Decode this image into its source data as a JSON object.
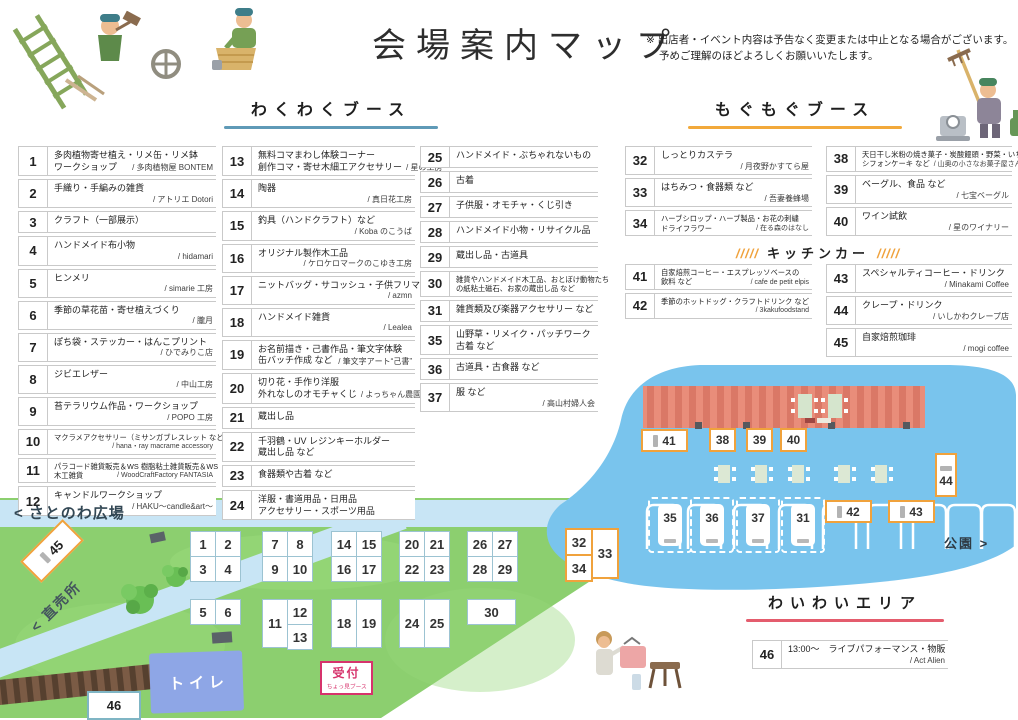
{
  "header": {
    "title": "会場案内マップ",
    "note1": "※ 出店者・イベント内容は予告なく変更または中止となる場合がございます。",
    "note2": "予めご理解のほどよろしくお願いいたします。"
  },
  "sections": {
    "wakuwaku": "わくわくブース",
    "mogumogu": "もぐもぐブース",
    "kitchen": "キッチンカー",
    "kitchen_slash": "/////",
    "waiwai": "わいわいエリア"
  },
  "colors": {
    "wakuwaku_underline": "#5f9ab7",
    "mogumogu_underline": "#f2a93b",
    "waiwai_underline": "#e45c6d",
    "kitchen_orange": "#f0a23c",
    "reception_pink": "#d6336c",
    "grass": "#8ccf6f",
    "water": "#79c4ed",
    "road": "#c8e5f5",
    "toilet_building": "#8ea6e6",
    "stage_building": "#e98d7a"
  },
  "booths": {
    "col1": [
      {
        "num": "1",
        "l1": "多肉植物寄せ植え・リメ缶・リメ鉢",
        "l2": "ワークショップ",
        "v": "/ 多肉植物屋 BONTEM"
      },
      {
        "num": "2",
        "l1": "手織り・手編みの雑貨",
        "v": "/ アトリエ Dotori"
      },
      {
        "num": "3",
        "l1": "クラフト（一部展示）"
      },
      {
        "num": "4",
        "l1": "ハンドメイド布小物",
        "v": "/ hidamari"
      },
      {
        "num": "5",
        "l1": "ヒンメリ",
        "v": "/ simarie 工房"
      },
      {
        "num": "6",
        "l1": "季節の草花苗・寄せ植えづくり",
        "v": "/ 朧月"
      },
      {
        "num": "7",
        "l1": "ぽち袋・ステッカー・はんこプリント",
        "v": "/ ひでみりこ店"
      },
      {
        "num": "8",
        "l1": "ジビエレザー",
        "v": "/ 中山工房"
      },
      {
        "num": "9",
        "l1": "苔テラリウム作品・ワークショップ",
        "v": "/ POPO 工房"
      },
      {
        "num": "10",
        "sm": true,
        "l1": "マクラメアクセサリー（ミサンガブレスレット など）",
        "v": "/ hana・ray macrame accessory"
      },
      {
        "num": "11",
        "sm": true,
        "l1": "パラコード雑貨販売＆WS 樹脂粘土雑貨販売＆WS",
        "l2": "木工雑貨",
        "v": "/ WoodCraftFactory FANTASIA"
      },
      {
        "num": "12",
        "l1": "キャンドルワークショップ",
        "v": "/ HAKU〜candle&art〜"
      }
    ],
    "col2": [
      {
        "num": "13",
        "l1": "無料コマまわし体験コーナー",
        "l2": "創作コマ・寄せ木細工アクセサリー",
        "v": "/ 星の工房"
      },
      {
        "num": "14",
        "l1": "陶器",
        "v": "/ 真日花工房"
      },
      {
        "num": "15",
        "l1": "釣具（ハンドクラフト）など",
        "v": "/ Koba のこうば"
      },
      {
        "num": "16",
        "l1": "オリジナル製作木工品",
        "v": "/ ケロケロマークのこゆき工房"
      },
      {
        "num": "17",
        "l1": "ニットバッグ・サコッシュ・子供フリマ",
        "v": "/ azmn"
      },
      {
        "num": "18",
        "l1": "ハンドメイド雑貨",
        "v": "/ Lealea"
      },
      {
        "num": "19",
        "l1": "お名前描き・己書作品・筆文字体験",
        "l2": "缶バッチ作成 など",
        "v": "/ 筆文字アート“己書”"
      },
      {
        "num": "20",
        "l1": "切り花・手作り洋服",
        "l2": "外れなしのオモチャくじ",
        "v": "/ よっちゃん農園"
      },
      {
        "num": "21",
        "l1": "蔵出し品"
      },
      {
        "num": "22",
        "l1": "千羽鶴・UV レジンキーホルダー",
        "l2": "蔵出し品 など"
      },
      {
        "num": "23",
        "l1": "食器類や古着 など"
      },
      {
        "num": "24",
        "l1": "洋服・書道用品・日用品",
        "l2": "アクセサリー・スポーツ用品"
      }
    ],
    "col3": [
      {
        "num": "25",
        "l1": "ハンドメイド・ぶちゃれないもの"
      },
      {
        "num": "26",
        "l1": "古着"
      },
      {
        "num": "27",
        "l1": "子供服・オモチャ・くじ引き"
      },
      {
        "num": "28",
        "l1": "ハンドメイド小物・リサイクル品"
      },
      {
        "num": "29",
        "l1": "蔵出し品・古道具"
      },
      {
        "num": "30",
        "sm": true,
        "l1": "雑貨やハンドメイド木工品、おとぼけ動物たち",
        "l2": "の紙粘土磁石、お家の蔵出し品 など"
      },
      {
        "num": "31",
        "l1": "雑貨類及び楽器アクセサリー など"
      },
      {
        "num": "35",
        "l1": "山野草・リメイク・パッチワーク",
        "l2": "古着 など"
      },
      {
        "num": "36",
        "l1": "古道具・古食器 など"
      },
      {
        "num": "37",
        "l1": "服 など",
        "v": "/ 高山村婦人会"
      }
    ],
    "col4": [
      {
        "num": "32",
        "l1": "しっとりカステラ",
        "v": "/ 月夜野かすてら屋"
      },
      {
        "num": "33",
        "l1": "はちみつ・食器類 など",
        "v": "/ 吾妻養蜂場"
      },
      {
        "num": "34",
        "sm": true,
        "l1": "ハーブシロップ・ハーブ製品・お花の刺繍",
        "l2": "ドライフラワー",
        "v": "/ 在る森のはなし"
      }
    ],
    "col5": [
      {
        "num": "38",
        "sm": true,
        "l1": "天日干し米粉の焼き菓子・炭酸饅頭・野菜・いちごのムース",
        "l2": "シフォンケーキ など",
        "v": "/ 山奥の小さなお菓子屋さん"
      },
      {
        "num": "39",
        "l1": "ベーグル、食品 など",
        "v": "/ 七宝ベーグル"
      },
      {
        "num": "40",
        "l1": "ワイン試飲",
        "v": "/ 星のワイナリー"
      }
    ],
    "col6": [
      {
        "num": "41",
        "sm": true,
        "l1": "自家焙煎コーヒー・エスプレッソベースの",
        "l2": "飲料 など",
        "v": "/ cafe de petit elpis"
      },
      {
        "num": "42",
        "sm": true,
        "l1": "季節のホットドッグ・クラフトドリンク など",
        "v": "/ 3kakufoodstand"
      }
    ],
    "col7": [
      {
        "num": "43",
        "l1": "スペシャルティコーヒー・ドリンク",
        "v": "/ Minakami Coffee"
      },
      {
        "num": "44",
        "l1": "クレープ・ドリンク",
        "v": "/ いしかわクレープ店"
      },
      {
        "num": "45",
        "l1": "自家焙煎珈琲",
        "v": "/ mogi coffee"
      }
    ],
    "waiwai": [
      {
        "num": "46",
        "l1": "13:00〜　ライブパフォーマンス・物販",
        "v": "/ Act Alien"
      }
    ]
  },
  "map": {
    "hiroba_label": "< さとのわ広場",
    "chokubai_label": "< 直売所",
    "toilet_label": "トイレ",
    "reception_label": "受付",
    "reception_sub": "ちょっ見ブース",
    "park_label": "公園 >",
    "stall45": "45",
    "stall46": "46",
    "grids": [
      {
        "x": 190,
        "y": 531,
        "cols": [
          [
            "1",
            "3"
          ],
          [
            "2",
            "4"
          ]
        ]
      },
      {
        "x": 262,
        "y": 531,
        "cols": [
          [
            "7",
            "9"
          ],
          [
            "8",
            "10"
          ]
        ]
      },
      {
        "x": 331,
        "y": 531,
        "cols": [
          [
            "14",
            "16"
          ],
          [
            "15",
            "17"
          ]
        ]
      },
      {
        "x": 399,
        "y": 531,
        "cols": [
          [
            "20",
            "22"
          ],
          [
            "21",
            "23"
          ]
        ]
      },
      {
        "x": 467,
        "y": 531,
        "cols": [
          [
            "26",
            "28"
          ],
          [
            "27",
            "29"
          ]
        ]
      },
      {
        "x": 190,
        "y": 599,
        "cols": [
          [
            "5"
          ],
          [
            "6"
          ]
        ]
      },
      {
        "x": 262,
        "y": 599,
        "cols": [
          [
            {
              "n": "11",
              "h": 2
            }
          ],
          [
            "12",
            "13"
          ]
        ]
      },
      {
        "x": 331,
        "y": 599,
        "cols": [
          [
            {
              "n": "18",
              "h": 2
            }
          ],
          [
            {
              "n": "19",
              "h": 2
            }
          ]
        ]
      },
      {
        "x": 399,
        "y": 599,
        "cols": [
          [
            {
              "n": "24",
              "h": 2
            }
          ],
          [
            {
              "n": "25",
              "h": 2
            }
          ]
        ]
      },
      {
        "x": 467,
        "y": 599,
        "cols": [
          [
            {
              "n": "30",
              "w": 2
            }
          ]
        ]
      },
      {
        "x": 565,
        "y": 528,
        "accent": "orange",
        "cols": [
          [
            "32",
            "34"
          ],
          [
            {
              "n": "33",
              "h": 2
            }
          ]
        ]
      }
    ],
    "vans": [
      {
        "n": "35",
        "x": 648,
        "y": 497
      },
      {
        "n": "36",
        "x": 690,
        "y": 497
      },
      {
        "n": "37",
        "x": 736,
        "y": 497
      },
      {
        "n": "31",
        "x": 781,
        "y": 497
      }
    ],
    "boxes": [
      {
        "n": "41",
        "x": 641,
        "y": 429,
        "type": "h"
      },
      {
        "n": "38",
        "x": 709,
        "y": 428,
        "type": "sq"
      },
      {
        "n": "39",
        "x": 746,
        "y": 428,
        "type": "sq"
      },
      {
        "n": "40",
        "x": 780,
        "y": 428,
        "type": "sq"
      },
      {
        "n": "42",
        "x": 825,
        "y": 500,
        "type": "h"
      },
      {
        "n": "43",
        "x": 888,
        "y": 500,
        "type": "h"
      },
      {
        "n": "44",
        "x": 935,
        "y": 453,
        "type": "v"
      }
    ]
  }
}
